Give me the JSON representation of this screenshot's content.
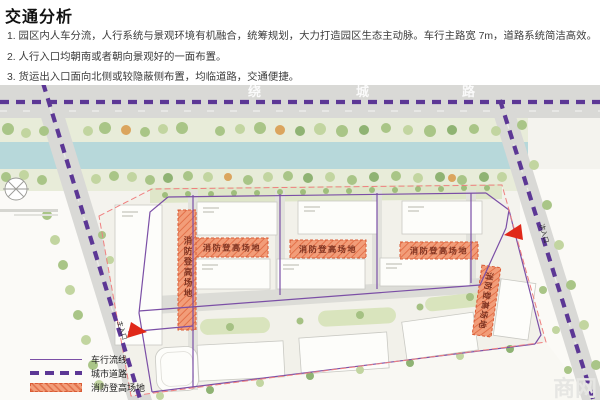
{
  "header": {
    "title": "交通分析",
    "points": [
      "1. 园区内人车分流，人行系统与景观环境有机融合，统筹规划，大力打造园区生态主动脉。车行主路宽 7m，道路系统简洁高效。",
      "2. 人行入口均朝南或者朝向景观好的一面布置。",
      "3. 货运出入口面向北侧或较隐蔽侧布置，均临道路，交通便捷。"
    ]
  },
  "map": {
    "main_road": {
      "chars": [
        "绕",
        "城",
        "路"
      ]
    },
    "fire_area_label": "消防登高场地",
    "main_entrance_label": "主入口",
    "secondary_entrance_label": "次入口"
  },
  "legend": {
    "items": [
      {
        "label": "车行流线",
        "type": "solid-line"
      },
      {
        "label": "城市道路",
        "type": "dashed-line"
      },
      {
        "label": "消防登高场地",
        "type": "hatched-area"
      }
    ]
  },
  "watermark": "商网",
  "colors": {
    "city_road_dashed": "#5c3795",
    "vehicle_circulation": "#7b4fa6",
    "fire_area_fill": "#f29d79",
    "fire_area_border": "#d95b35",
    "site_boundary": "#ef8080",
    "entrance_arrow": "#e02818",
    "river": "#b7d8da"
  }
}
